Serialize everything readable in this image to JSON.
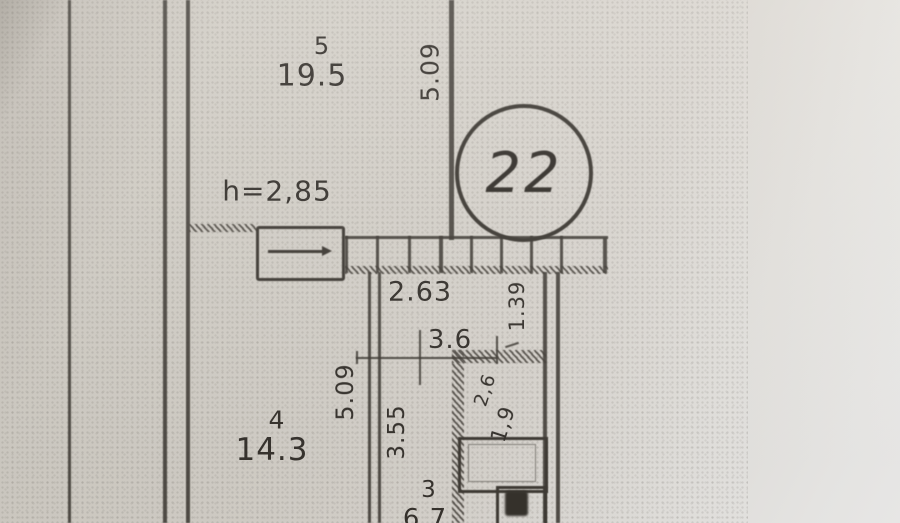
{
  "photo": {
    "description_label": "floor-plan-photocopy-photo"
  },
  "plan": {
    "apartment_number": "22",
    "ceiling_height_note": "h=2,85",
    "rooms": {
      "room5": {
        "number": "5",
        "area": "19.5"
      },
      "room4": {
        "number": "4",
        "area": "14.3"
      },
      "room3": {
        "number": "3",
        "area": "6.7"
      }
    },
    "dimensions": {
      "room5_height": "5.09",
      "room4_height": "5.09",
      "hall_height": "3.55",
      "upper_width": "2.63",
      "mid_width": "3.6",
      "bath_height": "1.39",
      "bath_diag_a": "2,6",
      "bath_diag_b": "1,9"
    },
    "ink_color": "#3b3733",
    "paper_color": "#d6d2cb"
  }
}
